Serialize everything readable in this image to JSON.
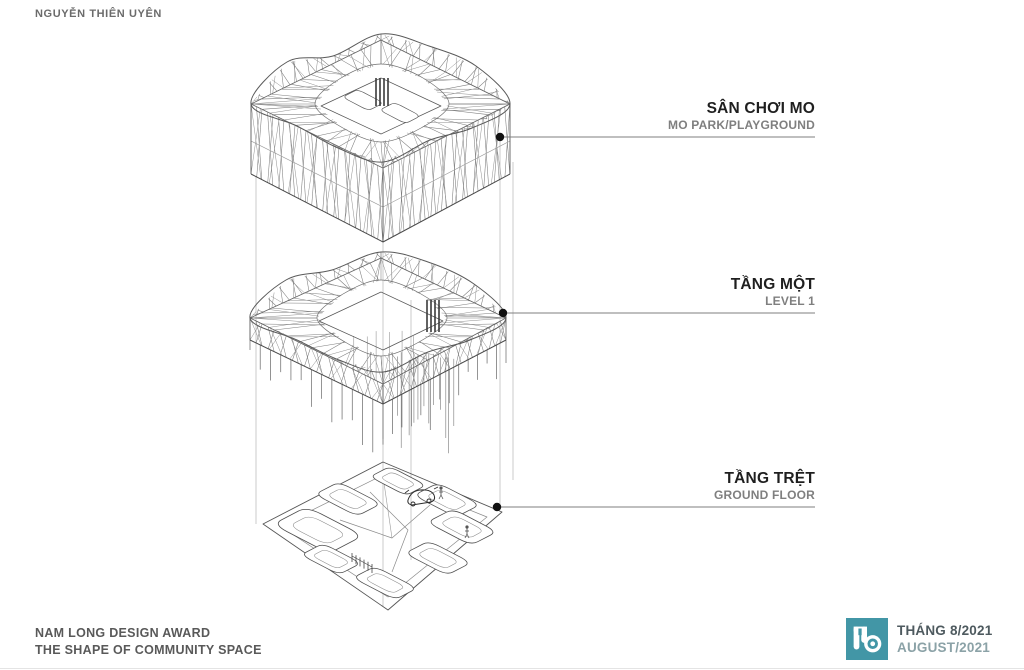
{
  "header": {
    "author": "NGUYỄN THIÊN UYÊN"
  },
  "diagram": {
    "type": "exploded-axonometric",
    "levels": [
      {
        "title_vi": "SÂN CHƠI MO",
        "title_en": "MO PARK/PLAYGROUND"
      },
      {
        "title_vi": "TẦNG MỘT",
        "title_en": "LEVEL 1"
      },
      {
        "title_vi": "TẦNG TRỆT",
        "title_en": "GROUND FLOOR"
      }
    ]
  },
  "footer": {
    "award_title": "NAM LONG DESIGN AWARD",
    "award_subtitle": "THE SHAPE OF COMMUNITY SPACE",
    "date_vi": "THÁNG 8/2021",
    "date_en": "AUGUST/2021"
  },
  "colors": {
    "accent_teal": "#4296a6",
    "title_text": "#1f1f1f",
    "muted_text": "#7f7f7f",
    "leader_line": "#7f7f7f",
    "drawing_line": "#6e6e6e"
  },
  "icons": {
    "logo": "mo-park-logo",
    "marker": "level-marker-dot"
  }
}
